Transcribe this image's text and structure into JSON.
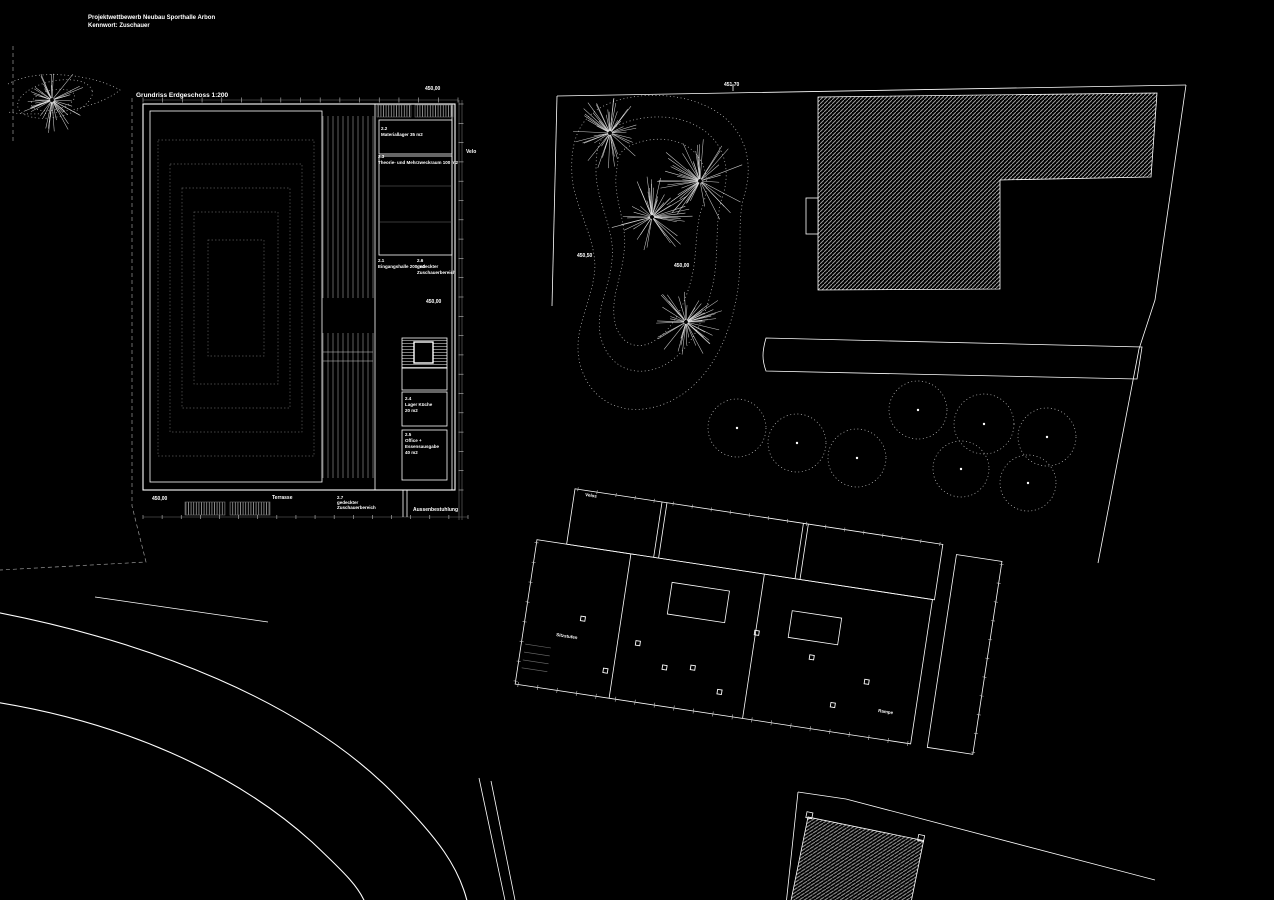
{
  "document": {
    "kind": "architectural competition plan",
    "background": "#000000"
  },
  "colors": {
    "background": "#000000",
    "line": "#ffffff",
    "dim_line": "#6f6f6f",
    "hatch": "#9b9b9b",
    "dotted": "#c8c8c8"
  },
  "header": {
    "line1": "Projektwettbewerb  Neubau Sporthalle  Arbon",
    "line2": "Kennwort: Zuschauer"
  },
  "floor_plan": {
    "title": "Grundriss Erdgeschoss 1:200",
    "rooms": [
      {
        "nr": "2.1",
        "name": "Eingangshalle",
        "area": "200 m2"
      },
      {
        "nr": "2.2",
        "name": "Materiallager",
        "area": "35 m2"
      },
      {
        "nr": "2.3",
        "name": "Theorie- und Mehrzweckraum",
        "area": "100 m2"
      },
      {
        "nr": "2.4",
        "name": "Lager Küche",
        "area": "20 m2"
      },
      {
        "nr": "2.5",
        "name": "Office + Essensausgabe",
        "area": "40 m2"
      },
      {
        "nr": "2.6",
        "name": "gedeckter Zuschauerbereich",
        "area": ""
      },
      {
        "nr": "2.7",
        "name": "gedeckter Zuschauerbereich",
        "area": ""
      }
    ],
    "annotations": [
      "Velo",
      "Terrasse",
      "Aussenbestuhlung"
    ],
    "elevation": "450,00"
  },
  "site_plan": {
    "elevations": [
      "451,70",
      "450,50",
      "450,00"
    ],
    "annotations": [
      "Velos",
      "Sitzstufen",
      "Rampe"
    ],
    "trees": [
      {
        "x": 52,
        "y": 100,
        "r": 34,
        "seed": 7
      },
      {
        "x": 610,
        "y": 133,
        "r": 40,
        "seed": 11
      },
      {
        "x": 700,
        "y": 181,
        "r": 46,
        "seed": 23
      },
      {
        "x": 652,
        "y": 217,
        "r": 42,
        "seed": 37
      },
      {
        "x": 686,
        "y": 322,
        "r": 40,
        "seed": 51
      }
    ],
    "tree_circles": [
      {
        "x": 737,
        "y": 428,
        "r": 29
      },
      {
        "x": 797,
        "y": 443,
        "r": 29
      },
      {
        "x": 857,
        "y": 458,
        "r": 29
      },
      {
        "x": 918,
        "y": 410,
        "r": 29
      },
      {
        "x": 984,
        "y": 424,
        "r": 30
      },
      {
        "x": 1047,
        "y": 437,
        "r": 29
      },
      {
        "x": 961,
        "y": 469,
        "r": 28
      },
      {
        "x": 1028,
        "y": 483,
        "r": 28
      }
    ]
  },
  "labels": [
    {
      "id": "title-line1",
      "text": "Projektwettbewerb  Neubau Sporthalle  Arbon",
      "x": 88,
      "y": 19,
      "size": 6,
      "bold": true
    },
    {
      "id": "title-line2",
      "text": "Kennwort: Zuschauer",
      "x": 88,
      "y": 27,
      "size": 6,
      "bold": true
    },
    {
      "id": "plan-title",
      "text": "Grundriss Erdgeschoss 1:200",
      "x": 136,
      "y": 97,
      "size": 6.5,
      "bold": true
    },
    {
      "id": "elev-plan-top",
      "text": "450,00",
      "x": 425,
      "y": 90,
      "size": 5,
      "bold": true
    },
    {
      "id": "room-22-nr",
      "text": "2.2",
      "x": 381,
      "y": 130,
      "size": 4.5,
      "bold": true
    },
    {
      "id": "room-22-name",
      "text": "Materiallager 35 m2",
      "x": 381,
      "y": 136,
      "size": 4.5,
      "bold": true
    },
    {
      "id": "room-23-nr",
      "text": "2.3",
      "x": 378,
      "y": 158,
      "size": 4.5,
      "bold": true
    },
    {
      "id": "room-23-name",
      "text": "Theorie- und Mehrzweckraum 100 m2",
      "x": 378,
      "y": 164,
      "size": 4.5,
      "bold": true
    },
    {
      "id": "velo-label",
      "text": "Velo",
      "x": 466,
      "y": 153,
      "size": 5,
      "bold": true
    },
    {
      "id": "room-21-nr",
      "text": "2.1",
      "x": 378,
      "y": 262,
      "size": 4.5,
      "bold": true
    },
    {
      "id": "room-21-name",
      "text": "Eingangshalle 200 m2",
      "x": 378,
      "y": 268,
      "size": 4.5,
      "bold": true
    },
    {
      "id": "room-26-nr",
      "text": "2.6",
      "x": 417,
      "y": 262,
      "size": 4.5,
      "bold": true
    },
    {
      "id": "room-26-name1",
      "text": "gedeckter",
      "x": 417,
      "y": 268,
      "size": 4.5,
      "bold": true
    },
    {
      "id": "room-26-name2",
      "text": "Zuschauerbereich",
      "x": 417,
      "y": 274,
      "size": 4.5,
      "bold": true
    },
    {
      "id": "elev-plan-mid",
      "text": "450,00",
      "x": 426,
      "y": 303,
      "size": 5,
      "bold": true
    },
    {
      "id": "room-24-nr",
      "text": "2.4",
      "x": 405,
      "y": 400,
      "size": 4.5,
      "bold": true
    },
    {
      "id": "room-24-name1",
      "text": "Lager Küche",
      "x": 405,
      "y": 406,
      "size": 4.5,
      "bold": true
    },
    {
      "id": "room-24-name2",
      "text": "20 m2",
      "x": 405,
      "y": 412,
      "size": 4.5,
      "bold": true
    },
    {
      "id": "room-25-nr",
      "text": "2.5",
      "x": 405,
      "y": 436,
      "size": 4.5,
      "bold": true
    },
    {
      "id": "room-25-name1",
      "text": "Office +",
      "x": 405,
      "y": 442,
      "size": 4.5,
      "bold": true
    },
    {
      "id": "room-25-name2",
      "text": "Essensausgabe",
      "x": 405,
      "y": 448,
      "size": 4.5,
      "bold": true
    },
    {
      "id": "room-25-name3",
      "text": "40 m2",
      "x": 405,
      "y": 454,
      "size": 4.5,
      "bold": true
    },
    {
      "id": "elev-plan-bottom",
      "text": "450,00",
      "x": 152,
      "y": 500,
      "size": 5,
      "bold": true
    },
    {
      "id": "terrasse-label",
      "text": "Terrasse",
      "x": 272,
      "y": 499,
      "size": 5,
      "bold": true
    },
    {
      "id": "room-27-nr",
      "text": "2.7",
      "x": 337,
      "y": 499,
      "size": 4.5,
      "bold": true
    },
    {
      "id": "room-27-name1",
      "text": "gedeckter",
      "x": 337,
      "y": 504,
      "size": 4.5,
      "bold": true
    },
    {
      "id": "room-27-name2",
      "text": "Zuschauerbereich",
      "x": 337,
      "y": 509,
      "size": 4.5,
      "bold": true
    },
    {
      "id": "aussenbestuhlung-label",
      "text": "Aussenbestuhlung",
      "x": 413,
      "y": 511,
      "size": 5,
      "bold": true
    },
    {
      "id": "elev-site-top",
      "text": "451,70",
      "x": 724,
      "y": 86,
      "size": 5,
      "bold": true
    },
    {
      "id": "elev-site-1",
      "text": "450,50",
      "x": 577,
      "y": 257,
      "size": 5,
      "bold": true
    },
    {
      "id": "elev-site-2",
      "text": "450,00",
      "x": 674,
      "y": 267,
      "size": 5,
      "bold": true
    },
    {
      "id": "velos-label",
      "text": "Velos",
      "x": 585,
      "y": 496,
      "size": 4.5,
      "bold": true,
      "rotate": 8.6
    },
    {
      "id": "sitzstufen-label",
      "text": "Sitzstufen",
      "x": 556,
      "y": 636,
      "size": 4.5,
      "bold": true,
      "rotate": 8.6
    },
    {
      "id": "rampe-label",
      "text": "Rampe",
      "x": 878,
      "y": 712,
      "size": 4.5,
      "bold": true,
      "rotate": 8.6
    }
  ]
}
